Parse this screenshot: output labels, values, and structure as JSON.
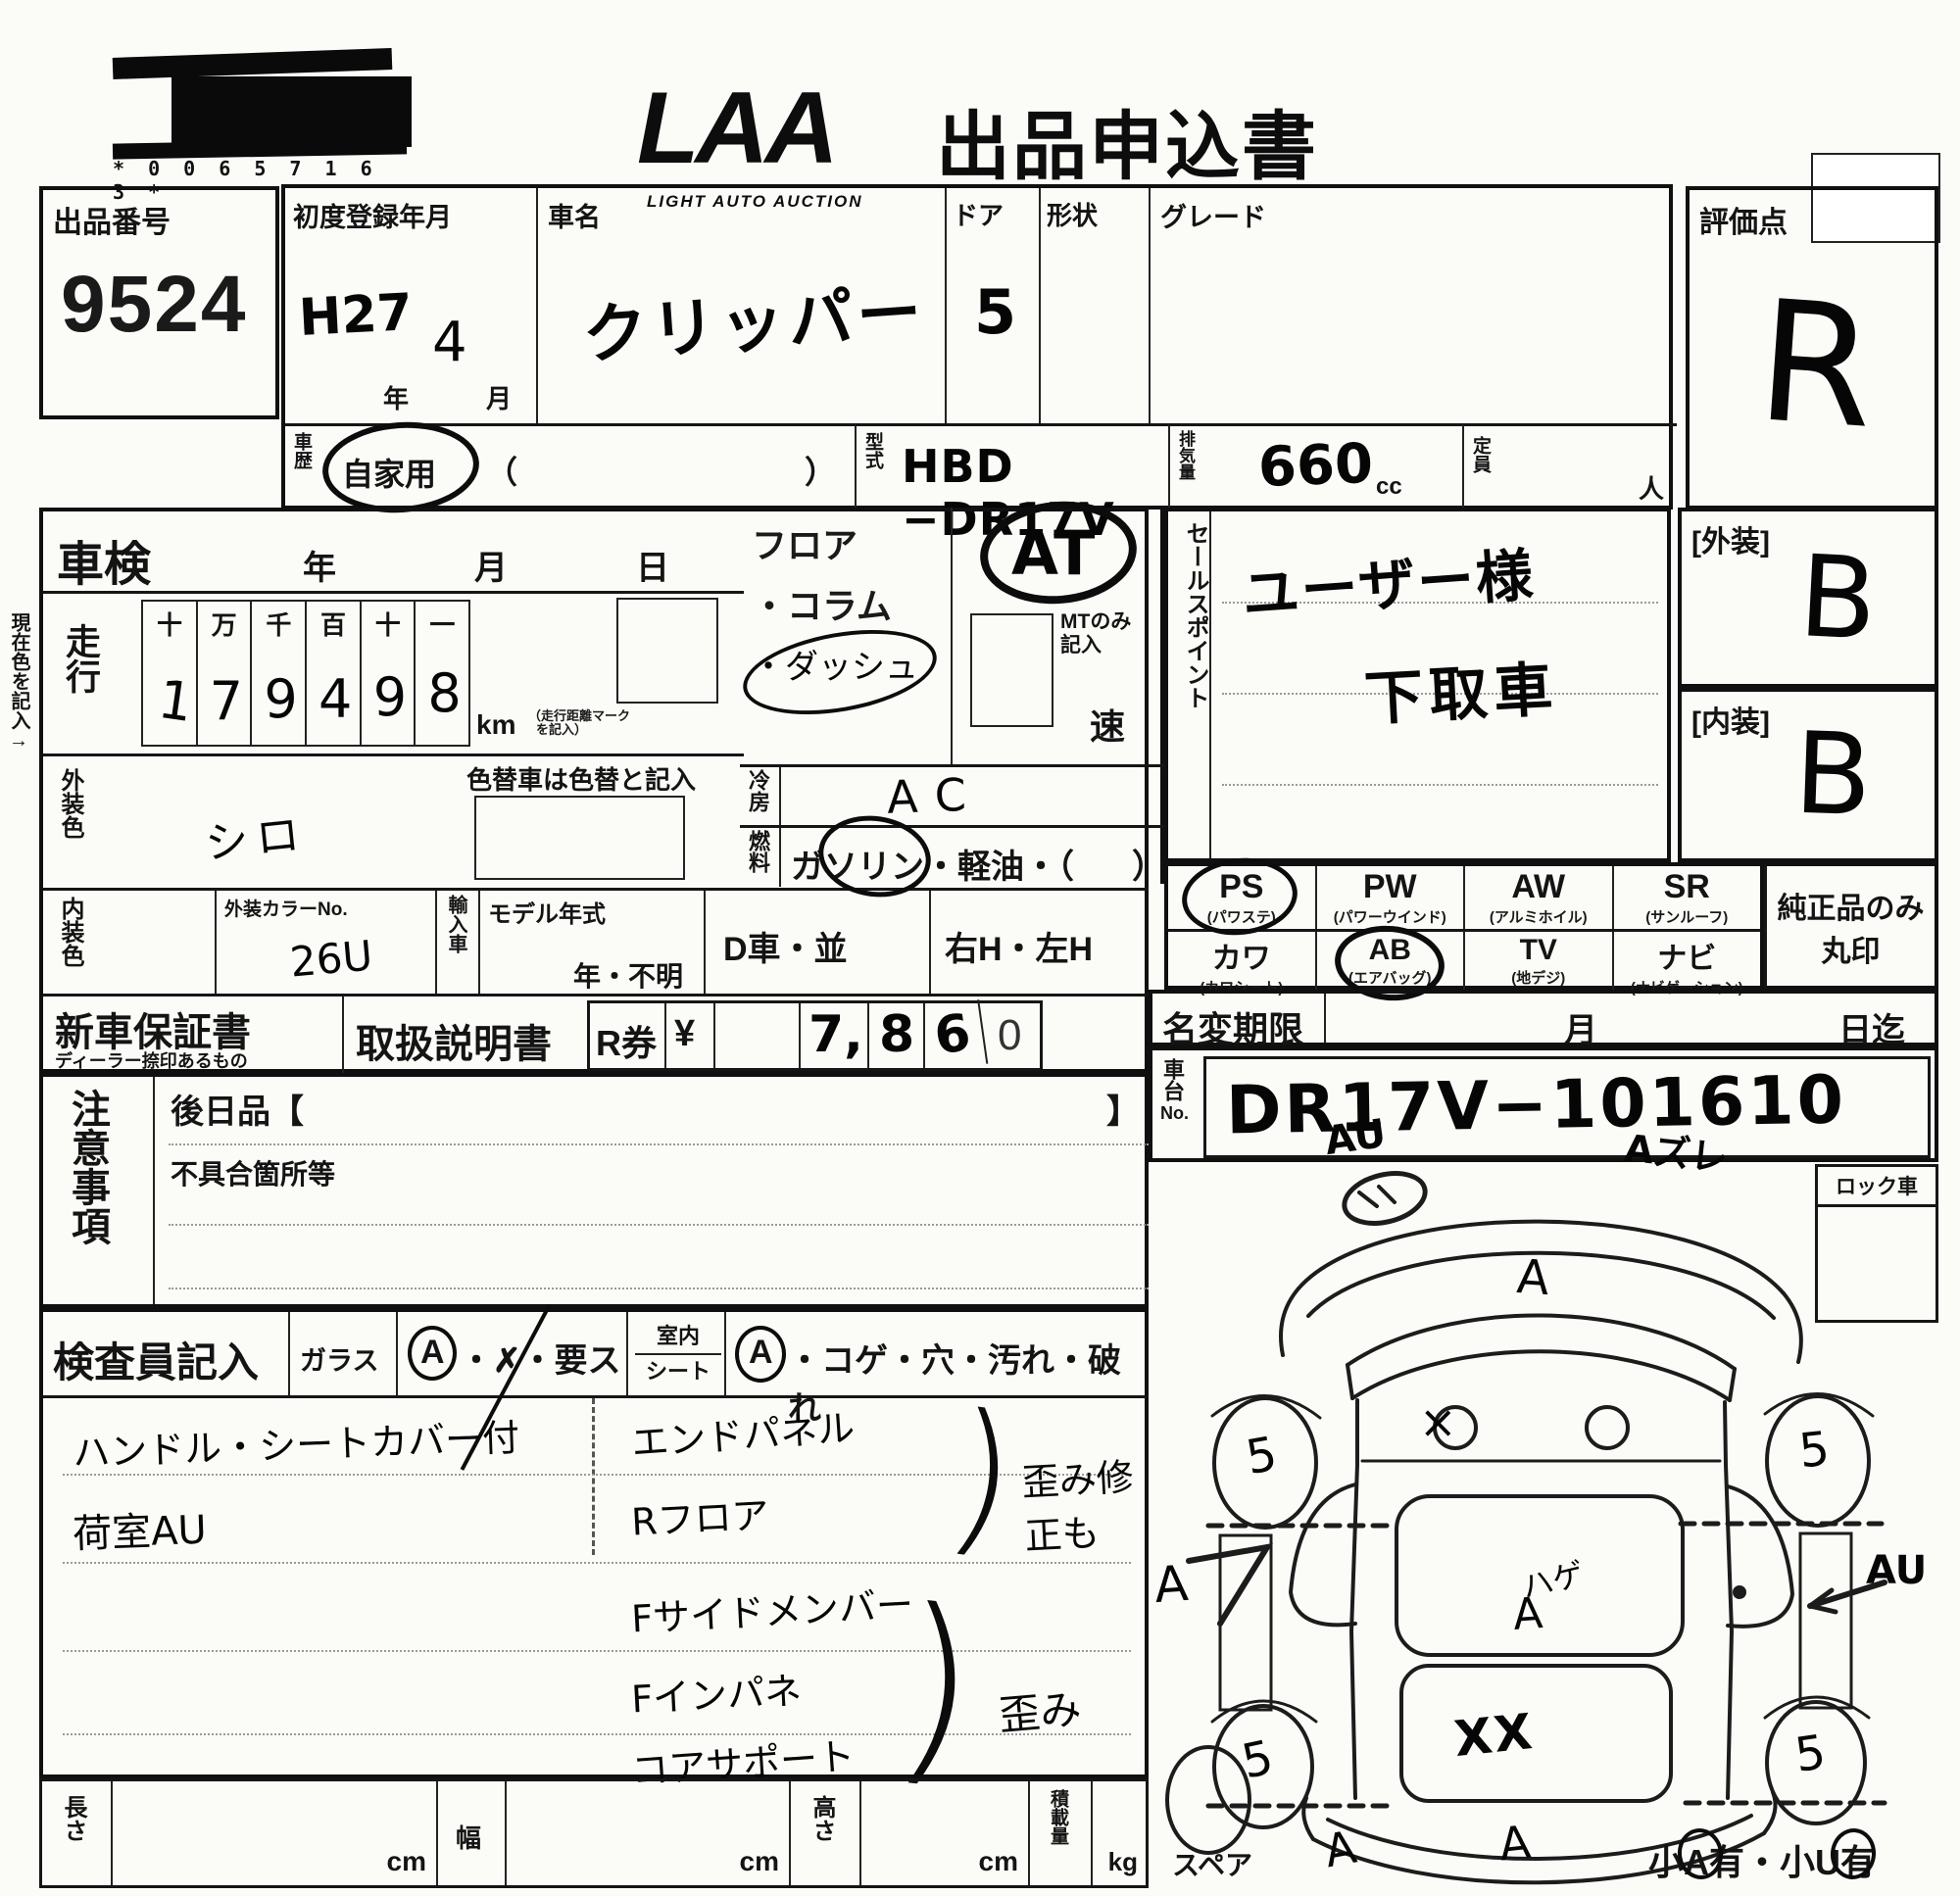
{
  "header": {
    "barcode_digits": "* 0 0 6 5 7 1 6 3 *",
    "logo_text": "LAA",
    "logo_subtext": "LIGHT AUTO AUCTION",
    "form_title": "出品申込書"
  },
  "top": {
    "auction_no_label": "出品番号",
    "auction_no": "9524",
    "first_reg_label": "初度登録年月",
    "first_reg_era": "H27",
    "year_unit": "年",
    "first_reg_month": "4",
    "month_unit": "月",
    "car_name_label": "車名",
    "car_name": "クリッパー",
    "door_label": "ドア",
    "door": "5",
    "shape_label": "形状",
    "grade_label": "グレード",
    "rating_label": "評価点",
    "rating": "R",
    "history_label": "車歴",
    "history_value": "自家用",
    "paren_open": "（",
    "paren_close": "）",
    "model_code_label": "型式",
    "model_code": "HBD −DR17V",
    "displacement_label": "排気量",
    "displacement": "660",
    "displacement_unit": "cc",
    "capacity_label": "定員",
    "capacity_unit": "人"
  },
  "left": {
    "shaken_label": "車検",
    "shaken_year": "年",
    "shaken_month": "月",
    "shaken_day": "日",
    "margin_note": "現在色を記入→",
    "mileage_label": "走行",
    "mileage_headers": [
      "十",
      "万",
      "千",
      "百",
      "十",
      "一"
    ],
    "mileage_digits": [
      "1",
      "7",
      "9",
      "4",
      "9",
      "8"
    ],
    "mileage_unit": "km",
    "mileage_note1": "（走行距離マーク",
    "mileage_note2": "を記入）",
    "ext_color_label": "外装色",
    "ext_color": "シロ",
    "color_change_note": "色替車は色替と記入",
    "int_color_label": "内装色",
    "ext_color_no_label": "外装カラーNo.",
    "ext_color_no": "26U",
    "import_label": "輸入車",
    "model_year_label": "モデル年式",
    "model_year_value": "年・不明",
    "d_car": "D車・並",
    "handle": "右H・左H"
  },
  "mid": {
    "floor_line1": "フロア",
    "floor_line2": "・コラム",
    "floor_line3": "・ダッシュ",
    "at_value": "AT",
    "mt_note": "MTのみ記入",
    "speed_unit": "速",
    "ac_label": "冷房",
    "ac_value": "AC",
    "fuel_label": "燃料",
    "fuel_options": "ガソリン・軽油・（",
    "fuel_close": "）"
  },
  "sales": {
    "label": "セールスポイント",
    "line1": "ユーザー様",
    "line2": "下取車"
  },
  "grades": {
    "exterior_label": "[外装]",
    "exterior": "B",
    "interior_label": "[内装]",
    "interior": "B",
    "genuine_note1": "純正品のみ",
    "genuine_note2": "丸印"
  },
  "equipment": {
    "r1": [
      {
        "code": "PS",
        "name": "(パワステ)"
      },
      {
        "code": "PW",
        "name": "(パワーウインド)"
      },
      {
        "code": "AW",
        "name": "(アルミホイル)"
      },
      {
        "code": "SR",
        "name": "(サンルーフ)"
      }
    ],
    "r2": [
      {
        "code": "カワ",
        "name": "(カワシート)"
      },
      {
        "code": "AB",
        "name": "(エアバッグ)"
      },
      {
        "code": "TV",
        "name": "(地デジ)"
      },
      {
        "code": "ナビ",
        "name": "(ナビゲーション)"
      }
    ]
  },
  "docs": {
    "warranty_label": "新車保証書",
    "warranty_sub": "ディーラー捺印あるもの",
    "manual_label": "取扱説明書",
    "r_ticket_label": "R券",
    "yen": "¥",
    "amount_d1": "7,",
    "amount_d2": "8",
    "amount_d3": "6",
    "amount_d4": "0"
  },
  "namechange": {
    "label": "名変期限",
    "month": "月",
    "day_until": "日迄"
  },
  "chassis": {
    "label": "車台",
    "label_no": "No.",
    "value": "DR17V−101610"
  },
  "notes": {
    "label": "注意事項",
    "later_items": "後日品【",
    "bracket_close": "】",
    "defects": "不具合箇所等"
  },
  "inspector": {
    "label": "検査員記入",
    "glass_label": "ガラス",
    "glass_a": "A",
    "glass_rest": "・✗・要ス",
    "cabin_label1": "室内",
    "cabin_label2": "シート",
    "seat_a": "A",
    "seat_rest": "・コゲ・穴・汚れ・破れ",
    "left_notes": [
      "ハンドル・シートカバー付",
      "荷室AU"
    ],
    "right_group1": [
      "エンドパネル",
      "Rフロア"
    ],
    "right_group1_note": "歪み修正も",
    "right_group2": [
      "Fサイドメンバー",
      "Fインパネ",
      "コアサポート"
    ],
    "right_group2_note": "歪み"
  },
  "measures": {
    "length_label": "長さ",
    "width_label": "幅",
    "height_label": "高さ",
    "load_label": "積載量",
    "cm": "cm",
    "kg": "kg"
  },
  "diagram": {
    "lock_label": "ロック車",
    "spare_label": "スペア",
    "ann_front_left": "AU",
    "ann_front_right": "Aズレ",
    "ann_hood": "A",
    "ann_windshield": "×",
    "wheel_marks": [
      "5",
      "5",
      "5",
      "5"
    ],
    "ann_side_left": "A",
    "ann_side_right": "AU",
    "ann_center_1": "ハゲ",
    "ann_center_2": "A",
    "ann_rear_window": "XX",
    "ann_rear_left": "A",
    "ann_rear_right": "A",
    "corner_parts": [
      "小",
      "A",
      "有・小",
      "U",
      "有"
    ]
  }
}
